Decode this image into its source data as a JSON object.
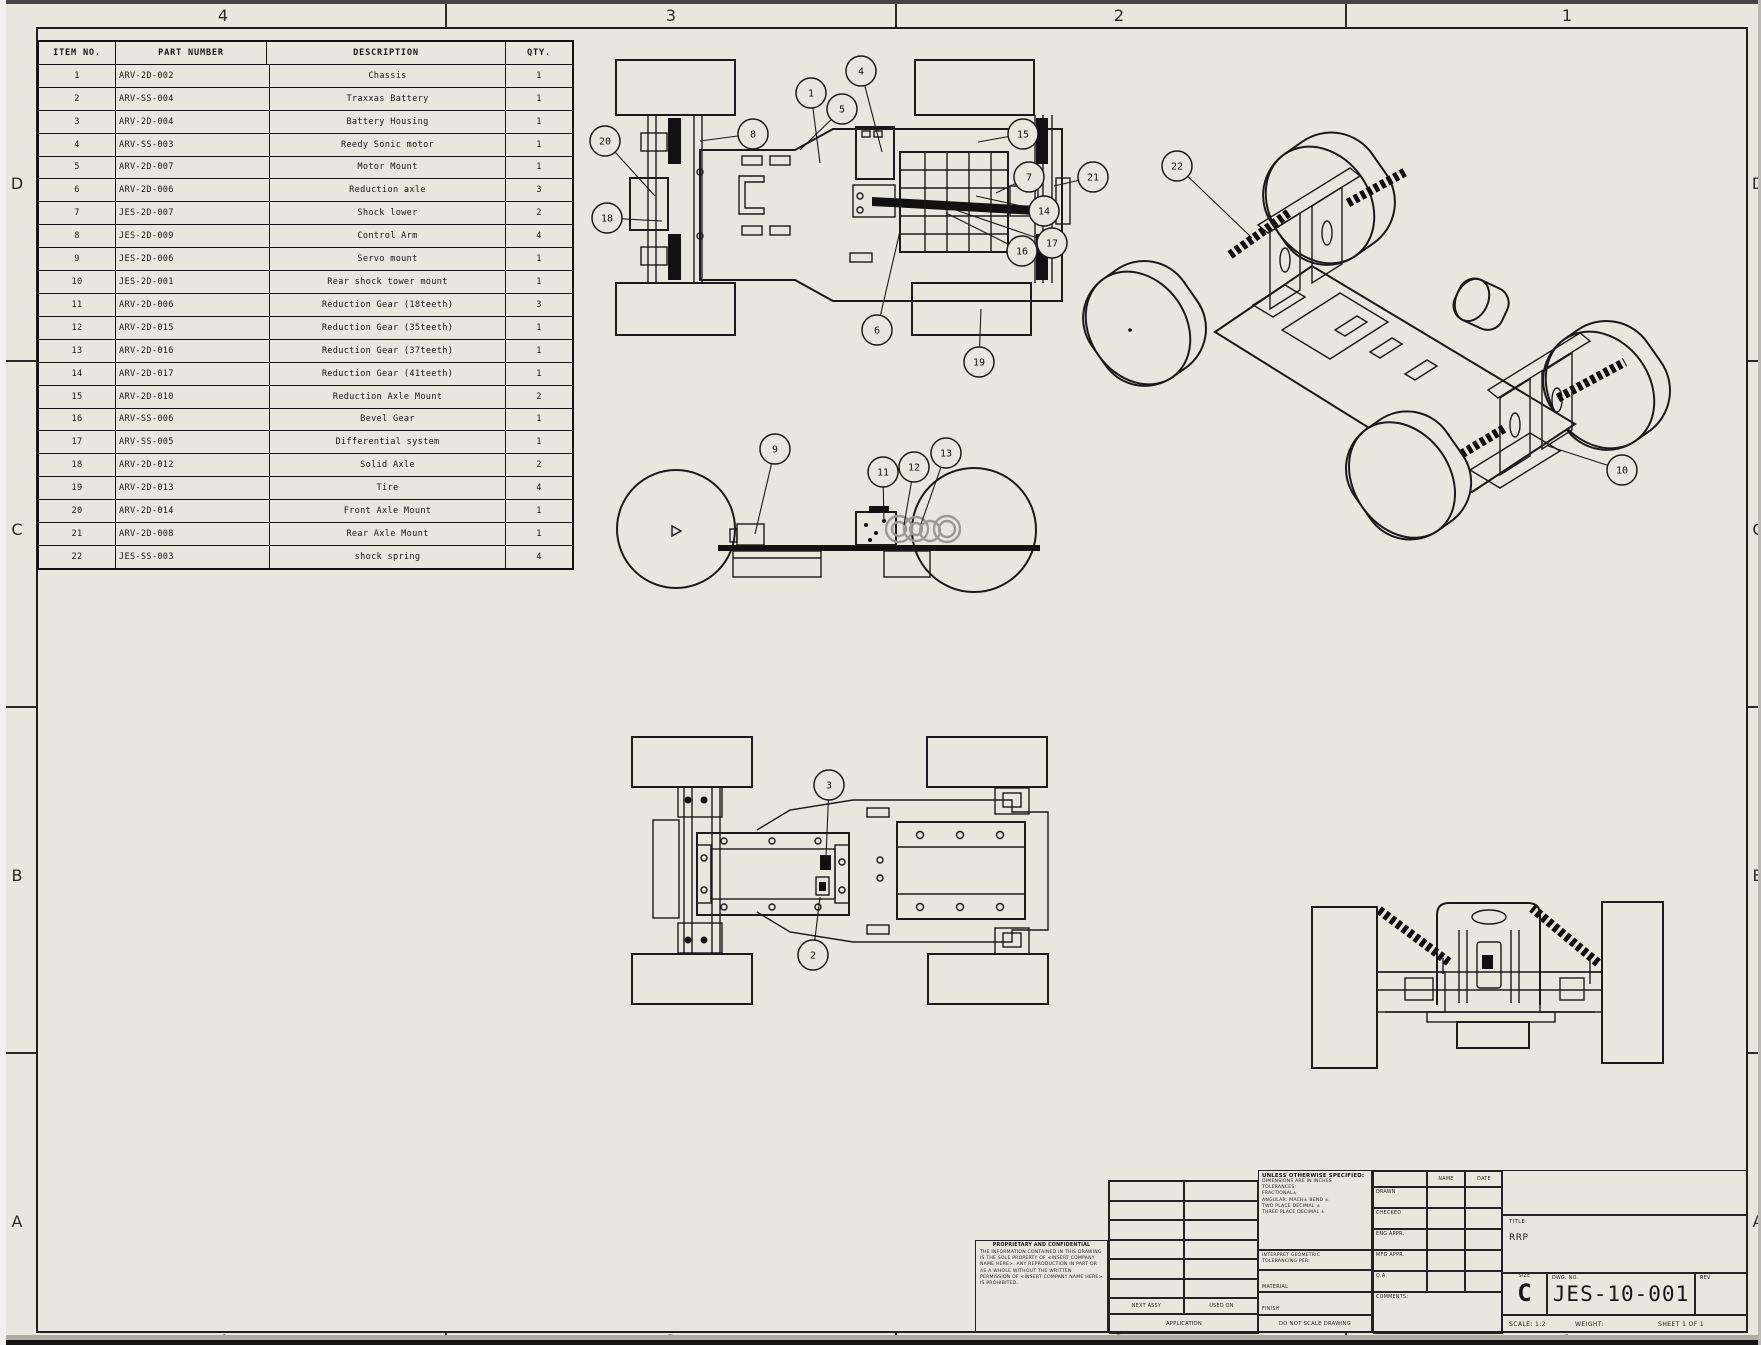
{
  "sheet": {
    "zones_top": [
      "4",
      "3",
      "2",
      "1"
    ],
    "zones_bottom": [
      "4",
      "3",
      "2",
      "1"
    ],
    "zones_left": [
      "D",
      "C",
      "B",
      "A"
    ],
    "zones_right": [
      "D",
      "C",
      "B",
      "A"
    ],
    "paper_color": "#e8e7dd",
    "line_color": "#1a1a1a"
  },
  "bom": {
    "headers": [
      "ITEM NO.",
      "PART NUMBER",
      "DESCRIPTION",
      "QTY."
    ],
    "rows": [
      [
        "1",
        "ARV-2D-002",
        "Chassis",
        "1"
      ],
      [
        "2",
        "ARV-SS-004",
        "Traxxas Battery",
        "1"
      ],
      [
        "3",
        "ARV-2D-004",
        "Battery Housing",
        "1"
      ],
      [
        "4",
        "ARV-SS-003",
        "Reedy Sonic motor",
        "1"
      ],
      [
        "5",
        "ARV-2D-007",
        "Motor Mount",
        "1"
      ],
      [
        "6",
        "ARV-2D-006",
        "Reduction axle",
        "3"
      ],
      [
        "7",
        "JES-2D-007",
        "Shock lower",
        "2"
      ],
      [
        "8",
        "JES-2D-009",
        "Control Arm",
        "4"
      ],
      [
        "9",
        "JES-2D-006",
        "Servo mount",
        "1"
      ],
      [
        "10",
        "JES-2D-001",
        "Rear shock tower mount",
        "1"
      ],
      [
        "11",
        "ARV-2D-006",
        "Reduction Gear (18teeth)",
        "3"
      ],
      [
        "12",
        "ARV-2D-015",
        "Reduction Gear (35teeth)",
        "1"
      ],
      [
        "13",
        "ARV-2D-016",
        "Reduction Gear (37teeth)",
        "1"
      ],
      [
        "14",
        "ARV-2D-017",
        "Reduction Gear (41teeth)",
        "1"
      ],
      [
        "15",
        "ARV-2D-010",
        "Reduction Axle Mount",
        "2"
      ],
      [
        "16",
        "ARV-SS-006",
        "Bevel Gear",
        "1"
      ],
      [
        "17",
        "ARV-SS-005",
        "Differential system",
        "1"
      ],
      [
        "18",
        "ARV-2D-012",
        "Solid Axle",
        "2"
      ],
      [
        "19",
        "ARV-2D-013",
        "Tire",
        "4"
      ],
      [
        "20",
        "ARV-2D-014",
        "Front Axle Mount",
        "1"
      ],
      [
        "21",
        "ARV-2D-008",
        "Rear Axle Mount",
        "1"
      ],
      [
        "22",
        "JES-SS-003",
        "shock spring",
        "4"
      ]
    ]
  },
  "balloons": [
    {
      "n": "20",
      "x": 605,
      "y": 141,
      "tx": 655,
      "ty": 196
    },
    {
      "n": "18",
      "x": 607,
      "y": 218,
      "tx": 662,
      "ty": 221
    },
    {
      "n": "8",
      "x": 753,
      "y": 134,
      "tx": 700,
      "ty": 141
    },
    {
      "n": "1",
      "x": 811,
      "y": 93,
      "tx": 820,
      "ty": 163
    },
    {
      "n": "5",
      "x": 842,
      "y": 109,
      "tx": 800,
      "ty": 150
    },
    {
      "n": "4",
      "x": 861,
      "y": 71,
      "tx": 882,
      "ty": 152
    },
    {
      "n": "15",
      "x": 1023,
      "y": 134,
      "tx": 978,
      "ty": 142
    },
    {
      "n": "7",
      "x": 1029,
      "y": 177,
      "tx": 996,
      "ty": 193
    },
    {
      "n": "21",
      "x": 1093,
      "y": 177,
      "tx": 1054,
      "ty": 186
    },
    {
      "n": "14",
      "x": 1044,
      "y": 211,
      "tx": 976,
      "ty": 196
    },
    {
      "n": "17",
      "x": 1052,
      "y": 243,
      "tx": 944,
      "ty": 206
    },
    {
      "n": "16",
      "x": 1022,
      "y": 251,
      "tx": 946,
      "ty": 213
    },
    {
      "n": "6",
      "x": 877,
      "y": 330,
      "tx": 900,
      "ty": 231
    },
    {
      "n": "19",
      "x": 979,
      "y": 362,
      "tx": 981,
      "ty": 309
    },
    {
      "n": "9",
      "x": 775,
      "y": 449,
      "tx": 755,
      "ty": 534
    },
    {
      "n": "11",
      "x": 883,
      "y": 472,
      "tx": 884,
      "ty": 523
    },
    {
      "n": "12",
      "x": 914,
      "y": 467,
      "tx": 904,
      "ty": 525
    },
    {
      "n": "13",
      "x": 946,
      "y": 453,
      "tx": 921,
      "ty": 524
    },
    {
      "n": "3",
      "x": 829,
      "y": 785,
      "tx": 826,
      "ty": 858
    },
    {
      "n": "2",
      "x": 813,
      "y": 955,
      "tx": 820,
      "ty": 897
    },
    {
      "n": "22",
      "x": 1177,
      "y": 166,
      "tx": 1252,
      "ty": 238
    },
    {
      "n": "10",
      "x": 1622,
      "y": 470,
      "tx": 1548,
      "ty": 446
    }
  ],
  "title_block": {
    "proprietary_title": "PROPRIETARY AND CONFIDENTIAL",
    "proprietary_body": "THE INFORMATION CONTAINED IN THIS DRAWING IS THE SOLE PROPERTY OF <INSERT COMPANY NAME HERE>. ANY REPRODUCTION IN PART OR AS A WHOLE WITHOUT THE WRITTEN PERMISSION OF <INSERT COMPANY NAME HERE> IS PROHIBITED.",
    "unless": "UNLESS OTHERWISE SPECIFIED:",
    "tol_lines": [
      "DIMENSIONS ARE IN INCHES",
      "TOLERANCES:",
      "FRACTIONAL±",
      "ANGULAR: MACH±  BEND ±",
      "TWO PLACE DECIMAL    ±",
      "THREE PLACE DECIMAL  ±"
    ],
    "interpret": "INTERPRET GEOMETRIC TOLERANCING PER:",
    "material_label": "MATERIAL",
    "finish_label": "FINISH",
    "do_not_scale": "DO NOT SCALE DRAWING",
    "name_header": "NAME",
    "date_header": "DATE",
    "rows": [
      "DRAWN",
      "CHECKED",
      "ENG APPR.",
      "MFG APPR.",
      "Q.A.",
      "COMMENTS:"
    ],
    "title_label": "TITLE:",
    "title_value": "RRP",
    "size_label": "SIZE",
    "size_value": "C",
    "dwg_label": "DWG.  NO.",
    "dwg_value": "JES-10-001",
    "rev_label": "REV",
    "scale_text": "SCALE: 1:2",
    "weight_text": "WEIGHT:",
    "sheet_text": "SHEET 1 OF 1",
    "next_assy": "NEXT ASSY",
    "used_on": "USED ON",
    "application": "APPLICATION"
  }
}
